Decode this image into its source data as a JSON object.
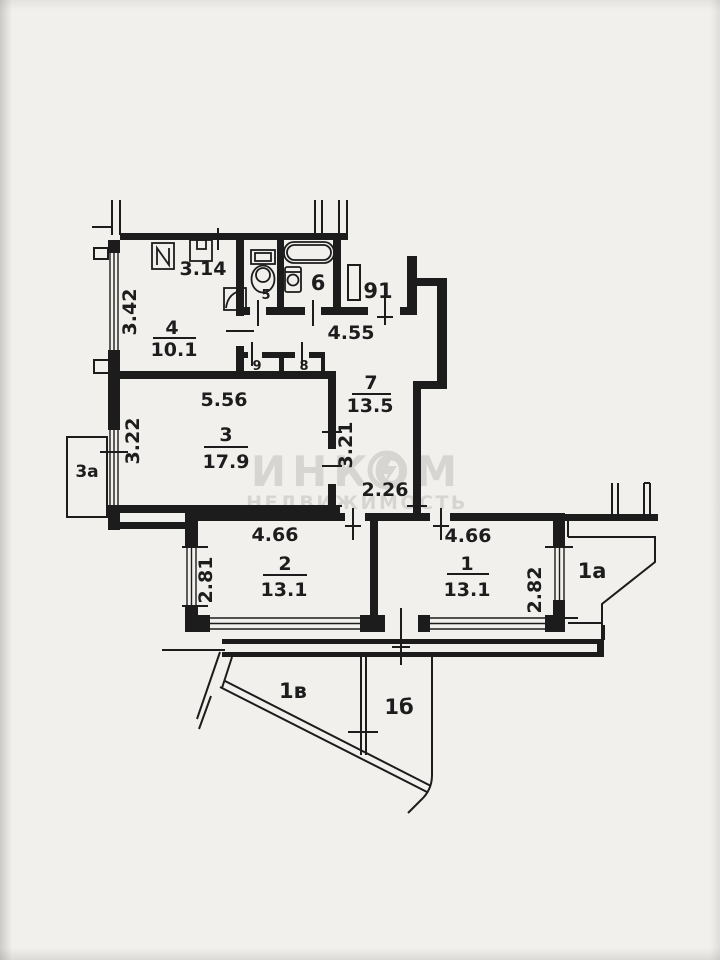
{
  "plan": {
    "apartment_number": "91",
    "watermark": {
      "brand": "ИНКОМ",
      "subtitle": "НЕДВИЖИМОСТЬ"
    },
    "rooms": {
      "room1": {
        "number": "1",
        "area": "13.1"
      },
      "room2": {
        "number": "2",
        "area": "13.1"
      },
      "room3": {
        "number": "3",
        "area": "17.9"
      },
      "kitchen": {
        "number": "4",
        "area": "10.1"
      },
      "wc": {
        "number": "5"
      },
      "bathroom": {
        "number": "6"
      },
      "corridor": {
        "number": "7",
        "area": "13.5"
      },
      "closet_b": {
        "number": "8"
      },
      "closet_a": {
        "number": "9"
      }
    },
    "annexes": {
      "balcony_left": {
        "label": "3а"
      },
      "balcony_right": {
        "label": "1а"
      },
      "terrace_v": {
        "label": "1в"
      },
      "terrace_b": {
        "label": "1б"
      }
    },
    "dims": {
      "kitchen_w": "3.14",
      "kitchen_d": "3.42",
      "hall_w": "4.55",
      "room3_w": "5.56",
      "room3_d": "3.22",
      "corridor_d": "3.21",
      "passage_w": "2.26",
      "room2_w": "4.66",
      "room2_d": "2.81",
      "room1_w": "4.66",
      "room1_d": "2.82"
    }
  },
  "colors": {
    "ink": "#1c1c1c",
    "paper": "#f1f0ed",
    "watermark": "#d7d5d1"
  }
}
